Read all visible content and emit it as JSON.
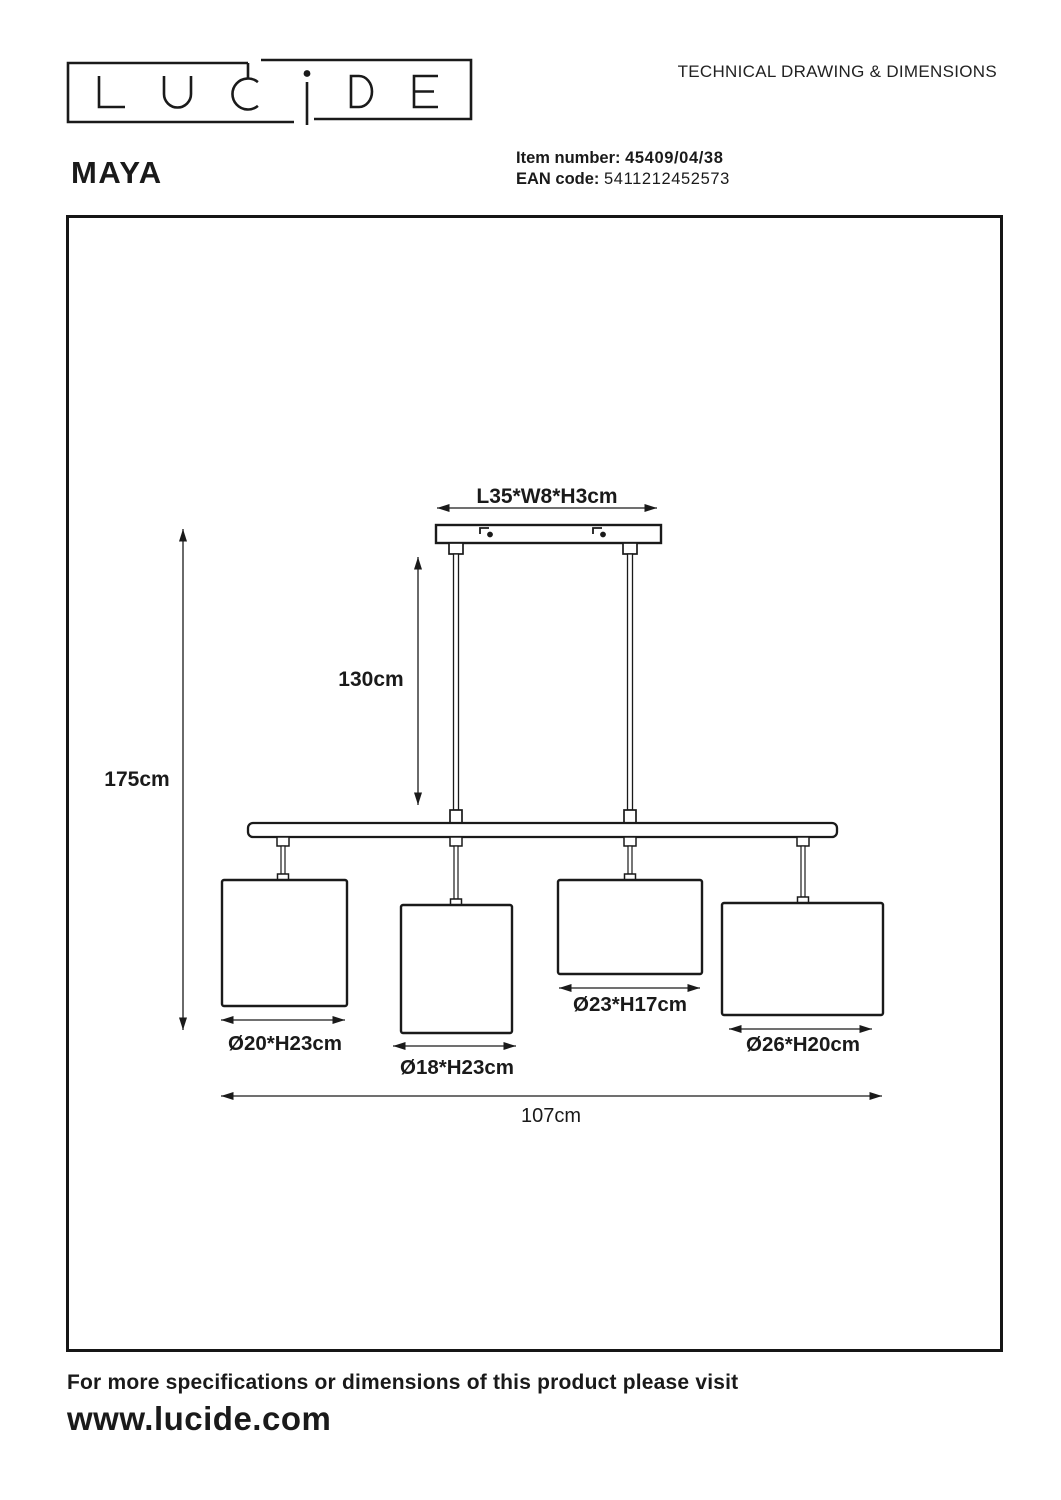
{
  "page": {
    "brand": "LUCIDE",
    "title": "TECHNICAL DRAWING & DIMENSIONS",
    "product_name": "MAYA",
    "item_number_label": "Item number:",
    "item_number_value": "45409/04/38",
    "ean_label": "EAN code:",
    "ean_value": "5411212452573",
    "footer_line": "For more specifications or dimensions of this product please visit",
    "footer_url": "www.lucide.com"
  },
  "drawing": {
    "canopy_dim": "L35*W8*H3cm",
    "drop_dim": "130cm",
    "height_dim": "175cm",
    "width_dim": "107cm",
    "shade1_dim": "Ø20*H23cm",
    "shade2_dim": "Ø18*H23cm",
    "shade3_dim": "Ø23*H17cm",
    "shade4_dim": "Ø26*H20cm"
  }
}
